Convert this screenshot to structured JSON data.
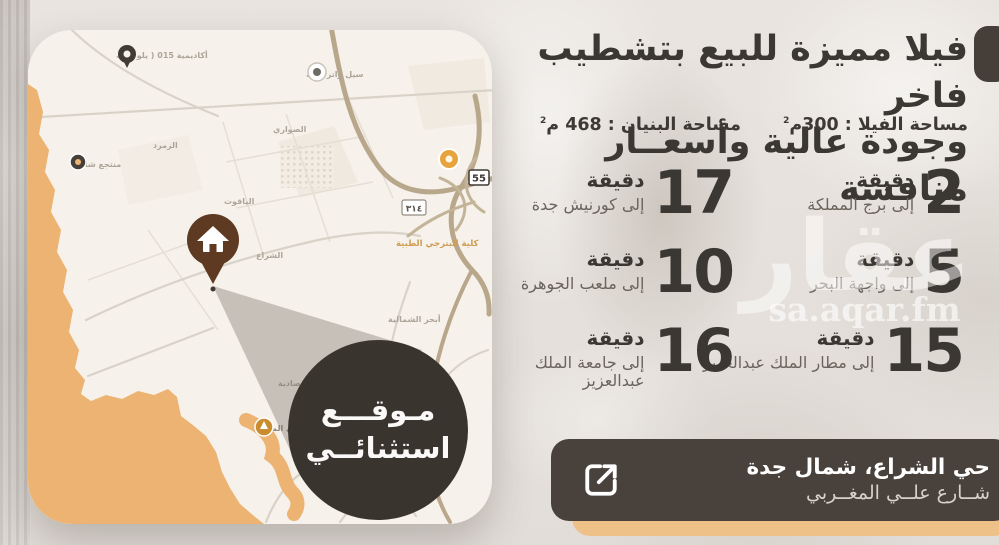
{
  "title": {
    "line1": "فيلا مميزة للبيع بتشطيب فاخر",
    "line2": "وجودة عالية وأسعــار منافسة"
  },
  "areas": {
    "villa_label": "مساحة الفيلا : 300م",
    "villa_sup": "2",
    "building_label": "مساحة البنيان : 468 م",
    "building_sup": "2"
  },
  "stats": [
    {
      "minutes": "2",
      "unit": "دقيقة",
      "destination": "إلى برج المملكة"
    },
    {
      "minutes": "17",
      "unit": "دقيقة",
      "destination": "إلى كورنيش جدة"
    },
    {
      "minutes": "5",
      "unit": "دقيقة",
      "destination": "إلى واجهة البحر"
    },
    {
      "minutes": "10",
      "unit": "دقيقة",
      "destination": "إلى ملعب الجوهرة"
    },
    {
      "minutes": "15",
      "unit": "دقيقة",
      "destination": "إلى مطار الملك عبدالعزيز"
    },
    {
      "minutes": "16",
      "unit": "دقيقة",
      "destination": "إلى جامعة الملك عبدالعزيز"
    }
  ],
  "watermark": {
    "brand": "عقار",
    "url": "sa.aqar.fm"
  },
  "location_badge": {
    "line1": "مـوقـــع",
    "line2": "استثنائــي"
  },
  "address": {
    "line1": "حي الشراع، شمال جدة",
    "line2": "شــارع علــي المغــربي"
  },
  "map": {
    "labels": [
      {
        "text": "أكاديمية 015 ( يلو بارك"
      },
      {
        "text": "سيل واتر بارك"
      },
      {
        "text": "منتجع شاطئ"
      },
      {
        "text": "الصواري"
      },
      {
        "text": "الزمرد"
      },
      {
        "text": "الياقوت"
      },
      {
        "text": "الشراع"
      },
      {
        "text": "كلية البترجي الطبية"
      },
      {
        "text": "أبحر الشمالية"
      },
      {
        "text": "شاطئ المحارة"
      },
      {
        "text": "الإسماعيلية"
      },
      {
        "text": "مدينة جدة الاقتصادية"
      }
    ],
    "shields": [
      {
        "number": "55"
      },
      {
        "number": "٣١٤"
      }
    ]
  },
  "colors": {
    "accent_dark": "#49413b",
    "sea_tan": "#ecb372",
    "pin_brown": "#5d3a21",
    "bar_shadow_orange": "#eec189",
    "badge_dark": "#3a342f",
    "text_dark": "#3b3733"
  }
}
